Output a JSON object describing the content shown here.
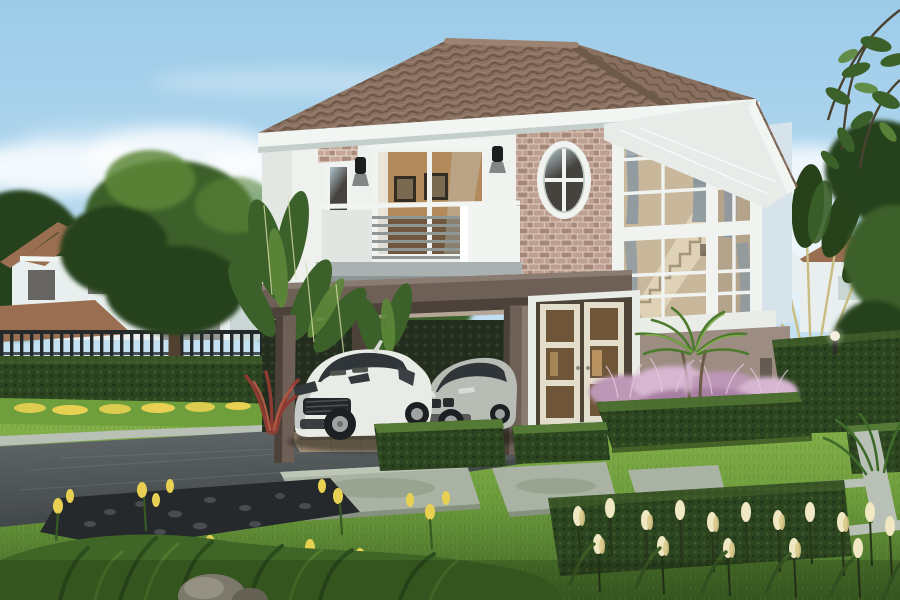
{
  "scene": {
    "title": "Architectural rendering of a modern two-storey house with carport, two cars and landscaped garden",
    "type": "3d-exterior-render",
    "time_of_day": "daytime, clear blue sky with light clouds",
    "objects": [
      {
        "name": "main-house",
        "note": "two-storey modern house, white upper walls, taupe lower walls, brown hip tile roof"
      },
      {
        "name": "brick-feature-wall",
        "note": "pink-beige stacked brick panel with oval window with cross muntins"
      },
      {
        "name": "balcony",
        "note": "white balcony with horizontal grey rail bars over the carport"
      },
      {
        "name": "sliding-glass-door",
        "note": "upper floor sliding door, framed pictures visible inside"
      },
      {
        "name": "corner-window",
        "note": "two-storey white-mullioned corner glazing with staircase and curtains inside"
      },
      {
        "name": "carport",
        "note": "dark taupe flat carport roof on square posts with ceiling light"
      },
      {
        "name": "white-sports-car",
        "note": "white GT-R style coupe parked under carport"
      },
      {
        "name": "silver-sedan",
        "note": "silver sedan parked beside the coupe"
      },
      {
        "name": "entrance-doors",
        "note": "cream French doors with glass panes, warm interior light"
      },
      {
        "name": "neighbour-houses-left",
        "note": "two white houses with terracotta roofs behind dark picket fence"
      },
      {
        "name": "neighbour-house-right",
        "note": "house roof visible behind travellers palm"
      },
      {
        "name": "travellers-palm",
        "note": "fan shaped palm with golden stems behind right hedge wall"
      },
      {
        "name": "banana-plants",
        "note": "banana foliage at left side of carport"
      },
      {
        "name": "big-tree-left",
        "note": "large green tree in front of neighbour house"
      },
      {
        "name": "purple-grass-bed",
        "note": "hedge-bordered bed of pink-purple fountain grass with small palm"
      },
      {
        "name": "hedge-cubes",
        "note": "square trimmed box hedges on the lawn"
      },
      {
        "name": "stepping-slabs",
        "note": "large pale concrete stepping slabs in the lawn"
      },
      {
        "name": "white-paving-strips",
        "note": "thin white paving strips inset in right lawn"
      },
      {
        "name": "driveway",
        "note": "dark grey driveway running to lower left"
      },
      {
        "name": "pebble-bed",
        "note": "black pebble mulch bed with yellow flowers"
      },
      {
        "name": "yellow-flower-row",
        "note": "row of yellow flowers along raised lawn curb"
      },
      {
        "name": "cream-tulip-bed",
        "note": "pale yellow tulips in front of long trimmed hedge, lower right"
      },
      {
        "name": "boulder",
        "note": "grey garden boulder at bottom edge"
      },
      {
        "name": "red-cordyline",
        "note": "red leafed plant left of the white car"
      },
      {
        "name": "garden-lamp",
        "note": "small lamp on the right hedge wall"
      }
    ]
  },
  "palette": {
    "sky_top": "#9ccbe9",
    "sky_mid": "#c2e0f2",
    "sky_horizon": "#eef7fa",
    "cloud": "#ffffff",
    "roof_tile": "#8a7061",
    "roof_tile_dark": "#63503f",
    "roof_tile_light": "#a78f7b",
    "roof_ridge": "#9b8271",
    "fascia": "#f2f6f3",
    "soffit": "#e7ece9",
    "soffit_shadow": "#c4cfcb",
    "wall_white": "#eef1ed",
    "wall_white_shade": "#d9dfdc",
    "wall_return": "#d7e3ea",
    "brick": "#c6a797",
    "brick_dark": "#ab8b7b",
    "mortar": "#e0cfc4",
    "carport": "#6e6057",
    "carport_dark": "#4c423a",
    "ceiling_warm": "#b5a697",
    "wall_taupe": "#a39287",
    "wall_taupe_dark": "#8a7a70",
    "band_white": "#e9ece7",
    "frame_white": "#f0f3ef",
    "glass_dark": "#46423d",
    "glass_cool": "#a9bec8",
    "interior_warm": "#b28a5c",
    "interior_dark": "#5d4a35",
    "stair": "#dfd2b6",
    "curtain": "#8b98a1",
    "door_cream": "#e3ddcb",
    "door_glass": "#6f5639",
    "balcony_white": "#f1f4f1",
    "rail_gray": "#8e9794",
    "balcony_base": "#aab2b1",
    "lawn": "#6f9e3d",
    "lawn_light": "#8ab54d",
    "lawn_dark": "#3f6626",
    "hedge": "#2c4420",
    "hedge_light": "#47682e",
    "hedge_top": "#557a36",
    "drive": "#626869",
    "drive_dark": "#43484a",
    "curb": "#b9c0b6",
    "paver": "#a8937d",
    "slab": "#a9b2a3",
    "slab_dark": "#87917f",
    "pebble": "#26292b",
    "tulip": "#efe8c2",
    "tulip_deep": "#dcc98b",
    "flower_yellow": "#e8d152",
    "purple": "#bd97b6",
    "purple_light": "#d6b6d0",
    "palm_stem": "#c9bc82",
    "leaf": "#3c6029",
    "leaf_dark": "#27421b",
    "leaf_light": "#5d8738",
    "trunk": "#52412f",
    "fence": "#23292b",
    "neighbor_roof": "#9a6e50",
    "neighbor_roof_dark": "#7c543c",
    "neighbor_wall": "#e9efef",
    "neighbor_wall_shade": "#c9d6d4",
    "car_white": "#e9ebe6",
    "car_white_shade": "#c6cac6",
    "car_silver": "#b9bbb5",
    "car_silver_dark": "#8f918c",
    "tire": "#1d2022",
    "rim": "#9fa3a2",
    "car_glass": "#2f3538",
    "stone": "#9a9488"
  }
}
